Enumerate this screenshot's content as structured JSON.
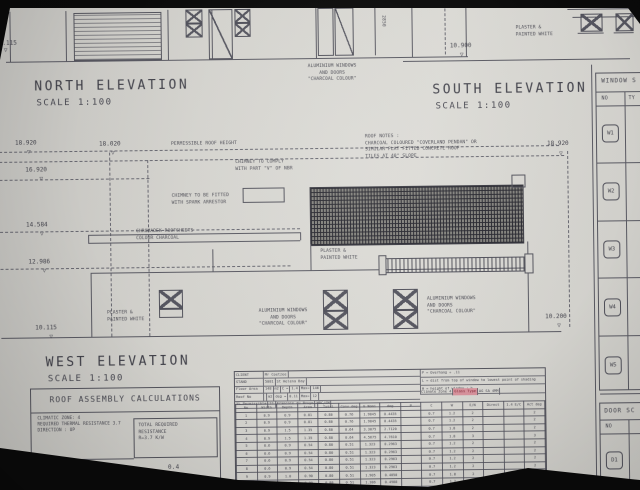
{
  "photo": {
    "paper_color": "#d6d5d0",
    "ink_color": "#4a4a53",
    "bg_color": "#0a0a0a",
    "highlight_pink": "#d9949e"
  },
  "top": {
    "north_title": "NORTH ELEVATION",
    "north_scale": "SCALE 1:100",
    "north_dim": "0.115",
    "south_title": "SOUTH ELEVATION",
    "south_scale": "SCALE 1:100",
    "south_dim": "10.900",
    "south_vdim": "2850",
    "plaster_note": "PLASTER &\nPAINTED WHITE",
    "alu_note": "ALUMINIUM WINDOWS\nAND DOORS\n\"CHARCOAL COLOUR\""
  },
  "west": {
    "title": "WEST ELEVATION",
    "scale": "SCALE 1:100",
    "dim_left_1": "18.920",
    "dim_left_2": "18.020",
    "dim_left_3": "16.920",
    "dim_left_4": "14.584",
    "dim_left_5": "12.986",
    "dim_left_6": "10.115",
    "dim_right_top": "18.920",
    "dim_right_bottom": "10.200",
    "permissible_note": "PERMISSIBLE ROOF HEIGHT",
    "chimney_comply_note": "CHIMNEY TO COMPLY\nWITH PART \"V\" OF NBR",
    "chimney_spark_note": "CHIMNEY TO BE FITTED\nWITH SPARK ARRESTOR",
    "chromadek_note": "CHROMADEK ROOFSHEETS\nCOLOUR CHARCOAL",
    "roof_notes": "ROOF NOTES :\nCHARCOAL COLOURED \"COVERLAND PENDAN\" OR\nSIMILAR FLAT FITTED CONCRETE ROOF\nTILES AT 40° SLOPE",
    "plaster_note_left": "PLASTER &\nPAINTED WHITE",
    "plaster_note_mid": "PLASTER &\nPAINTED WHITE",
    "alu_note_left": "ALUMINIUM WINDOWS\nAND DOORS\n\"CHARCOAL COLOUR\"",
    "alu_note_right": "ALUMINIUM WINDOWS\nAND DOORS\n\"CHARCOAL COLOUR\""
  },
  "window_schedule": {
    "title": "WINDOW S",
    "col_no": "NO",
    "col_type": "TY",
    "rows": [
      "W1",
      "W2",
      "W3",
      "W4",
      "W5"
    ]
  },
  "door_schedule": {
    "title": "DOOR SC",
    "col_no": "NO",
    "rows": [
      "D1"
    ]
  },
  "roof_calc": {
    "title": "ROOF ASSEMBLY CALCULATIONS",
    "lines": "CLIMATIC ZONE: 4\nREQUIRED THERMAL RESISTANCE 3.7\nDIRECTION : UP",
    "total_box": "TOTAL REQUIRED\nRESISTANCE\nR=3.7 K/W",
    "r_value_label": "R VALUE OF ROOF",
    "r_value": "0.4"
  },
  "glazing_table": {
    "info_left_rows": [
      [
        "CLIENT",
        "Mr Coetzee"
      ],
      [
        "STAND",
        "5081",
        "St Helena Bay"
      ],
      [
        "Floor Area",
        "148",
        "m2",
        "C =",
        "1.4",
        "Max=",
        "146"
      ],
      [
        "Roof No",
        "",
        "m2",
        "deg =",
        "0.11",
        "Max=",
        "12"
      ],
      [
        "5% Permissible",
        "21",
        "Francois du Bruyn",
        "MBC/SM"
      ]
    ],
    "info_right_lines": [
      "P = Overhang + .11",
      "L = dist from top of window to lowest point of shading",
      "H = height of window + h"
    ],
    "climate_zone": "Climate Zone 4",
    "glass_type_label": "Glass Type",
    "glass_type_value": "AG SA 4MM",
    "columns": [
      "No",
      "Width",
      "Depth",
      "Area",
      "Total",
      "Conv.deg",
      "E Nomi",
      "deg",
      "P",
      "C",
      "W",
      "E/N",
      "Direct",
      "1.4 E/C",
      "Act deg"
    ],
    "rows": [
      [
        "1",
        "0.9",
        "0.9",
        "0.81",
        "0.80",
        "0.76",
        "1.9845",
        "0.4435",
        "",
        "0.7",
        "1.2",
        "2",
        "",
        "",
        "2"
      ],
      [
        "2",
        "0.9",
        "0.9",
        "0.81",
        "0.80",
        "0.76",
        "1.9845",
        "0.4435",
        "",
        "0.7",
        "1.2",
        "2",
        "",
        "",
        "2"
      ],
      [
        "3",
        "0.9",
        "1.5",
        "1.35",
        "0.80",
        "0.64",
        "3.3075",
        "2.7120",
        "",
        "0.7",
        "1.8",
        "2",
        "",
        "",
        "2"
      ],
      [
        "4",
        "0.9",
        "1.5",
        "1.35",
        "0.80",
        "0.64",
        "4.5675",
        "4.7610",
        "",
        "0.7",
        "1.8",
        "3",
        "",
        "",
        "3"
      ],
      [
        "5",
        "0.6",
        "0.9",
        "0.54",
        "0.80",
        "0.51",
        "1.323",
        "0.2963",
        "",
        "0.7",
        "1.2",
        "2",
        "",
        "",
        "2"
      ],
      [
        "6",
        "0.6",
        "0.9",
        "0.54",
        "0.80",
        "0.51",
        "1.323",
        "0.2963",
        "",
        "0.7",
        "1.2",
        "2",
        "",
        "",
        "2"
      ],
      [
        "7",
        "0.6",
        "0.9",
        "0.54",
        "0.80",
        "0.51",
        "1.323",
        "0.2963",
        "",
        "0.7",
        "1.2",
        "2",
        "",
        "",
        "2"
      ],
      [
        "8",
        "0.6",
        "0.9",
        "0.54",
        "0.80",
        "0.51",
        "1.323",
        "0.2963",
        "",
        "0.7",
        "1.2",
        "2",
        "",
        "",
        "2"
      ],
      [
        "9",
        "0.9",
        "1.0",
        "0.90",
        "0.80",
        "0.51",
        "1.905",
        "0.4050",
        "",
        "0.7",
        "1.8",
        "2",
        "",
        "",
        "2"
      ],
      [
        "10",
        "0.6",
        "1.5",
        "0.90",
        "0.80",
        "0.51",
        "1.386",
        "0.4988",
        "",
        "0.7",
        "1.2",
        "2",
        "",
        "",
        "2"
      ],
      [
        "11",
        "1.5",
        "1.5",
        "2.25",
        "0.80",
        "0.51",
        "4.7135",
        "1.2578",
        "",
        "0.7",
        "1.8",
        "3",
        "",
        "",
        "3"
      ]
    ]
  }
}
